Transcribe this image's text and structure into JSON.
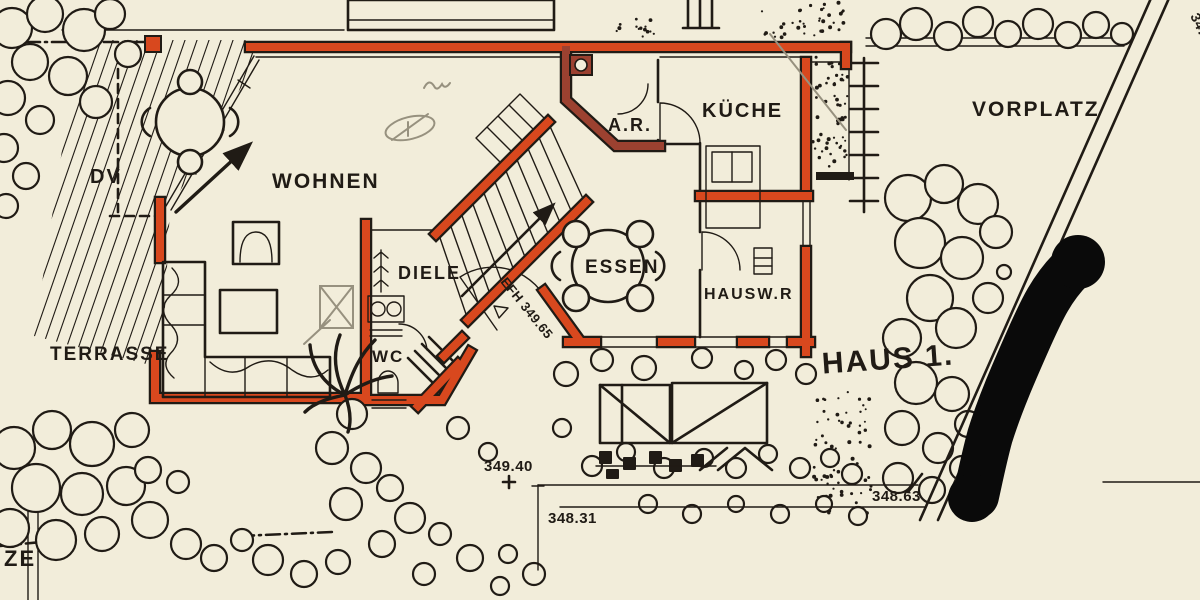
{
  "colors": {
    "paper": "#f2edda",
    "ink": "#201b15",
    "wall_red": "#d8481e",
    "wall_dark": "#9c4130",
    "pencil": "#97917f"
  },
  "rooms": {
    "wohnen": "WOHNEN",
    "essen": "ESSEN",
    "kueche": "KÜCHE",
    "abstellraum": "A.R.",
    "hauswirtschaft": "HAUSW.R",
    "diele": "DIELE",
    "wc": "WC",
    "terrasse": "TERRASSE",
    "vorplatz": "VORPLATZ",
    "dv": "DV"
  },
  "site": {
    "house_label": "HAUS 1.",
    "boundary_label_partial": "ZE",
    "corner_elevation_partial": "347"
  },
  "elevations": {
    "entry_floor": "EFH 349.65",
    "spot_a": "349.40",
    "spot_b": "348.31",
    "spot_c": "348.63"
  }
}
